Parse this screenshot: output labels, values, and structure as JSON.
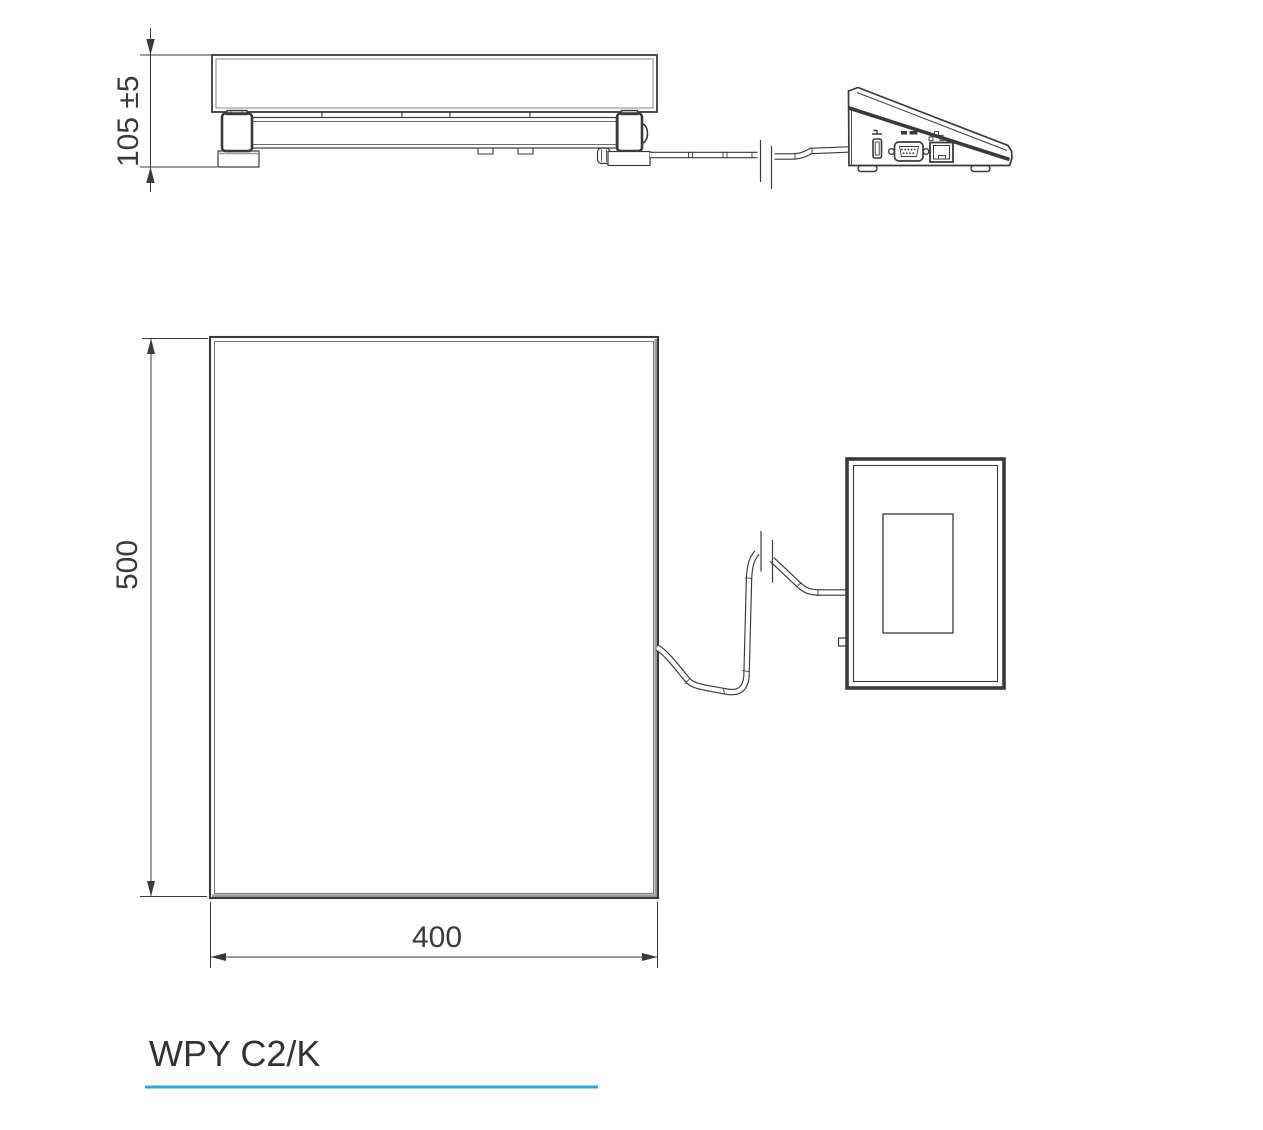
{
  "title": {
    "label": "WPY C2/K"
  },
  "dimensions": {
    "height": "105 ±5",
    "depth": "500",
    "width": "400"
  },
  "colors": {
    "line": "#3a3a3a",
    "line_thin": "#5a5a5a",
    "shadow_gray": "#9b9b9b",
    "accent_underline": "#29a8e0"
  }
}
